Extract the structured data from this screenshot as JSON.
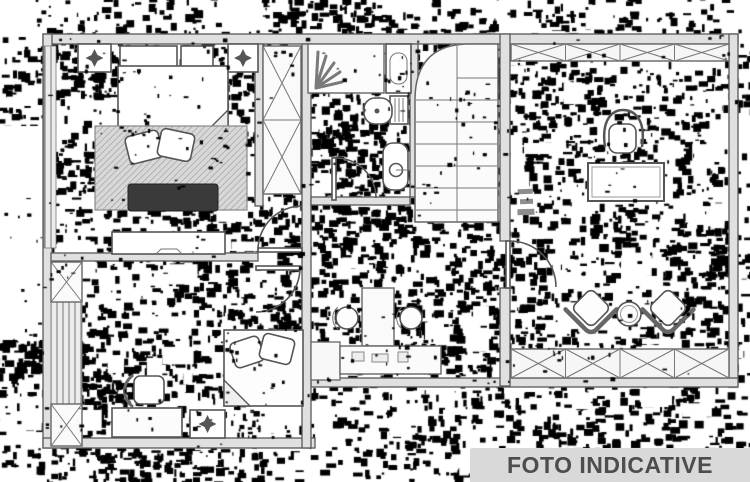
{
  "watermark": {
    "text": "FOTO INDICATIVE"
  },
  "palette": {
    "paper": "#ffffff",
    "line": "#4a4a4a",
    "wall_fill": "#e0e0e0",
    "noise": "#000000",
    "banner_bg": "#d9d9d9",
    "banner_fg": "#4d4d4d"
  },
  "noise": {
    "seed": 20240613,
    "under": {
      "clusters": 660,
      "spread": 30,
      "blob_min": 2,
      "blob_max": 10,
      "blobs_min": 3,
      "blobs_max": 13,
      "white_blobs": 110
    },
    "over": {
      "clusters": 175,
      "spread": 22,
      "blob_min": 1,
      "blob_max": 5,
      "blobs_min": 2,
      "blobs_max": 7,
      "white_blobs": 0
    },
    "white_patches": [
      [
        0,
        126,
        44,
        214
      ]
    ]
  },
  "floorplan": {
    "kind": "apartment floor plan, heavily dithered scan",
    "rooms": [
      {
        "name": "bedroom-top-left",
        "items": [
          "double-bed",
          "pillows",
          "rug",
          "dark-bench",
          "nightstand-left",
          "nightstand-right",
          "headboard-panels",
          "dresser",
          "wardrobe"
        ]
      },
      {
        "name": "bathroom-top",
        "items": [
          "shower",
          "washbasin-column",
          "toilet",
          "bidet",
          "door"
        ]
      },
      {
        "name": "staircase",
        "items": [
          "two-flight-stairs",
          "curved-landing"
        ]
      },
      {
        "name": "studio-room-right",
        "items": [
          "window-band-top",
          "office-chair",
          "desk",
          "dimension-marks",
          "door",
          "armchair-left",
          "round-table",
          "armchair-right",
          "window-band-bottom"
        ]
      },
      {
        "name": "vanity-area-middle",
        "items": [
          "counter",
          "tall-cabinet",
          "washbasin-left",
          "washbasin-right"
        ]
      },
      {
        "name": "bedroom-bottom-left",
        "items": [
          "single-bed",
          "pillows",
          "chair",
          "desk",
          "nightstand",
          "wardrobe-top",
          "wall-hatch",
          "wardrobe-bottom",
          "double-doors"
        ]
      }
    ]
  }
}
